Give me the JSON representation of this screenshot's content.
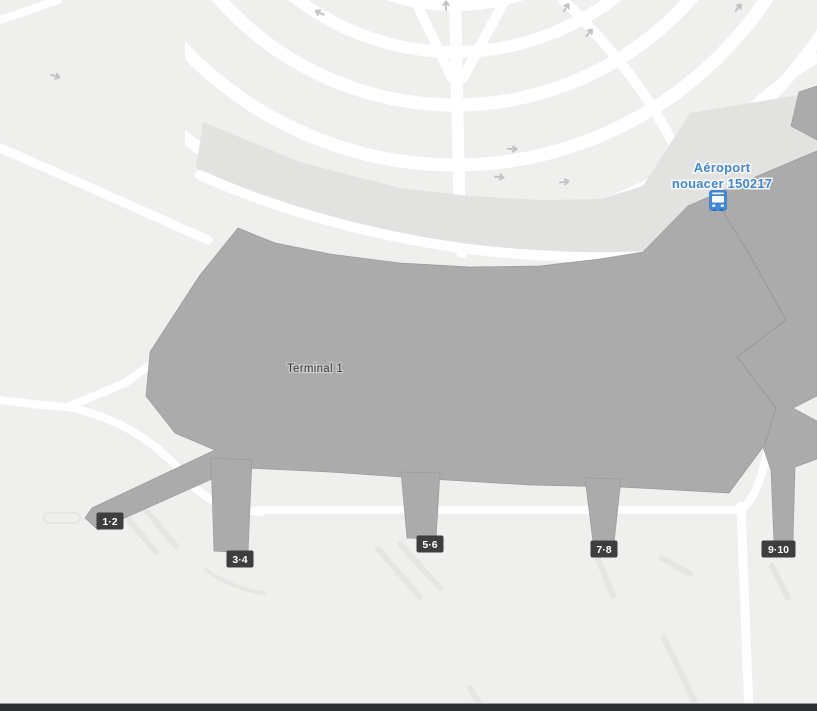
{
  "map": {
    "terminal": {
      "label": "Terminal 1"
    },
    "transit_station": {
      "line1": "Aéroport",
      "line2": "nouacer 150217",
      "icon": "bus-station-icon"
    },
    "gates": [
      {
        "label": "1·2"
      },
      {
        "label": "3·4"
      },
      {
        "label": "5·6"
      },
      {
        "label": "7·8"
      },
      {
        "label": "9·10"
      }
    ],
    "colors": {
      "background": "#eff0ee",
      "road": "#ffffff",
      "elevated_roadway": "#e2e3e1",
      "building": "#aaabaa",
      "building_outline": "#9b9c9b",
      "gate_badge": "#3d3e40",
      "gate_badge_text": "#ffffff",
      "transit_blue": "#4287d6",
      "terminal_text": "#3b3b3b",
      "direction_arrow": "#c2c3c2",
      "apron_marking": "#e4e6e3",
      "bottom_bar": "#2d2f31"
    }
  }
}
